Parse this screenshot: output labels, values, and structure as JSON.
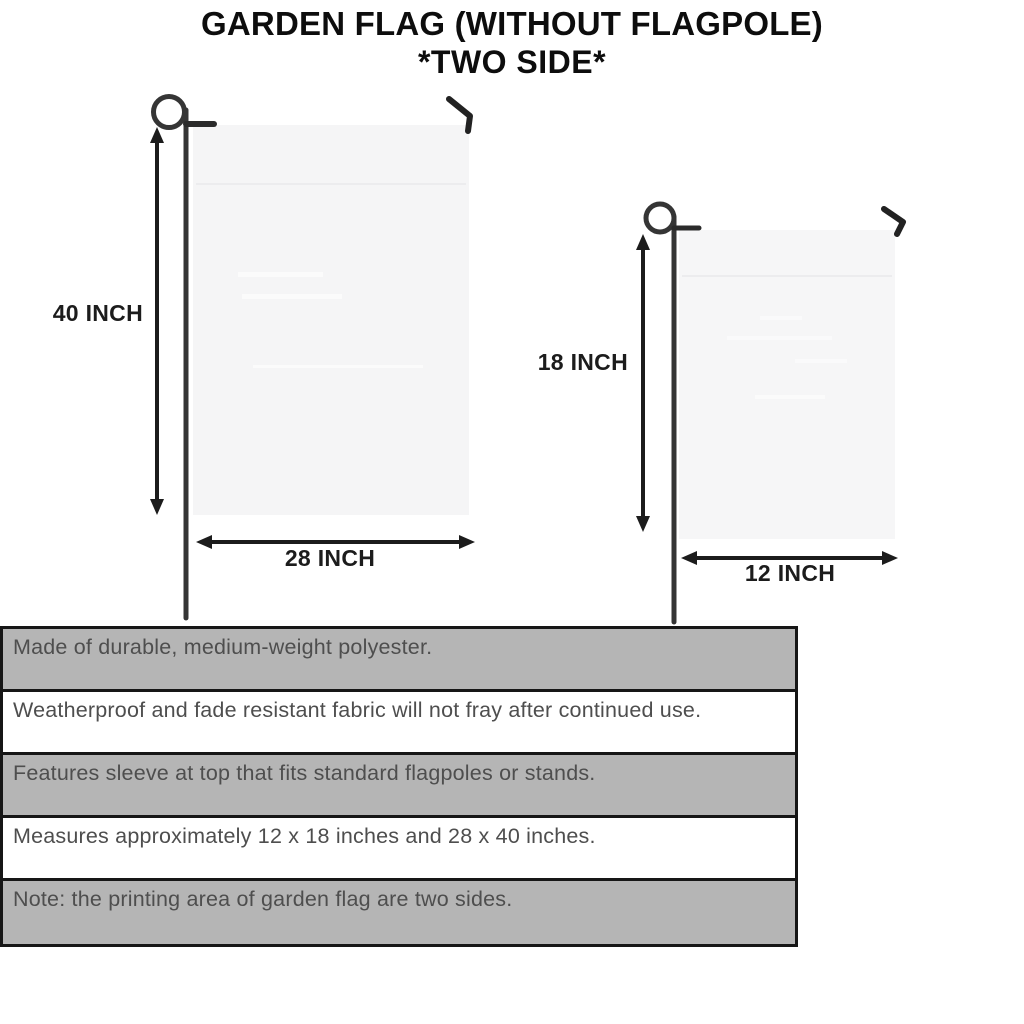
{
  "title": {
    "line1": "GARDEN FLAG (WITHOUT FLAGPOLE)",
    "line2": "*TWO SIDE*"
  },
  "flags": {
    "large": {
      "height_label": "40 INCH",
      "width_label": "28 INCH"
    },
    "small": {
      "height_label": "18 INCH",
      "width_label": "12 INCH"
    }
  },
  "features": [
    {
      "text": "Made of durable, medium-weight polyester."
    },
    {
      "text": "Weatherproof and fade resistant fabric will not fray after continued use."
    },
    {
      "text": "Features sleeve at top that fits standard flagpoles or stands."
    },
    {
      "text": "Measures approximately 12 x 18 inches and 28 x 40 inches."
    },
    {
      "text": "Note: the printing area of garden flag are two sides."
    }
  ],
  "colors": {
    "row_shaded": "#b5b5b5",
    "row_plain": "#ffffff",
    "table_border": "#161616",
    "flag_fill": "#f5f5f6",
    "pole": "#353535",
    "hook": "#222222",
    "arrow": "#1c1c1c",
    "table_text": "#4e4e4e",
    "title_text": "#0d0d0d"
  }
}
